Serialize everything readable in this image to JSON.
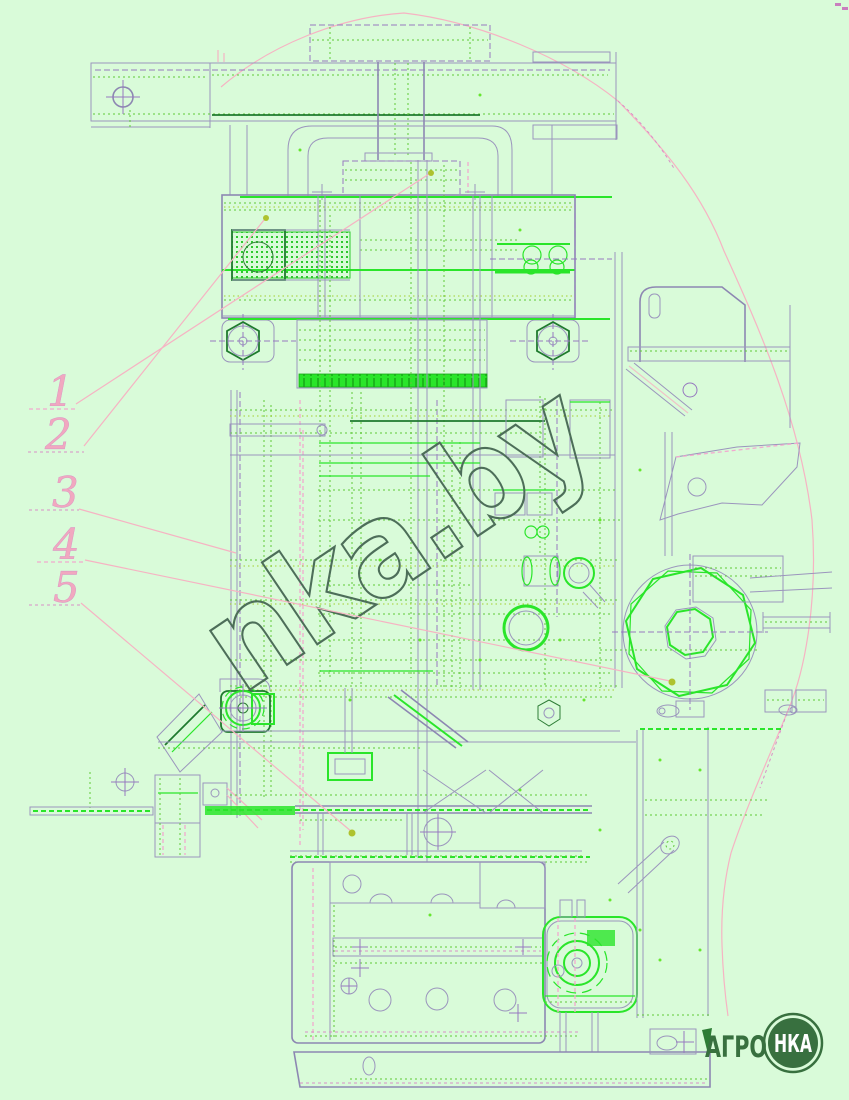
{
  "canvas": {
    "width": 849,
    "height": 1100,
    "background": "#d9fbd9"
  },
  "watermark": {
    "text": "nka.by",
    "color": "#4d6e59"
  },
  "callouts": [
    {
      "label": "1"
    },
    {
      "label": "2"
    },
    {
      "label": "3"
    },
    {
      "label": "4"
    },
    {
      "label": "5"
    }
  ],
  "logo": {
    "left_text": "АГРО",
    "circle_text": "НКА",
    "green": "#38703f",
    "circle_text_color": "#ffffff"
  },
  "colors": {
    "bright_green": "#2ae52a",
    "dotted_green": "#5fc838",
    "yellow_green": "#a2cf2e",
    "dark_green": "#1f7a2e",
    "structure_gray": "#9b95bd",
    "pink": "#f6b3c3",
    "magenta": "#d98fc6",
    "purple": "#9678bf",
    "olive_dot": "#aec22e",
    "callout_pink": "#f1a8bf"
  }
}
